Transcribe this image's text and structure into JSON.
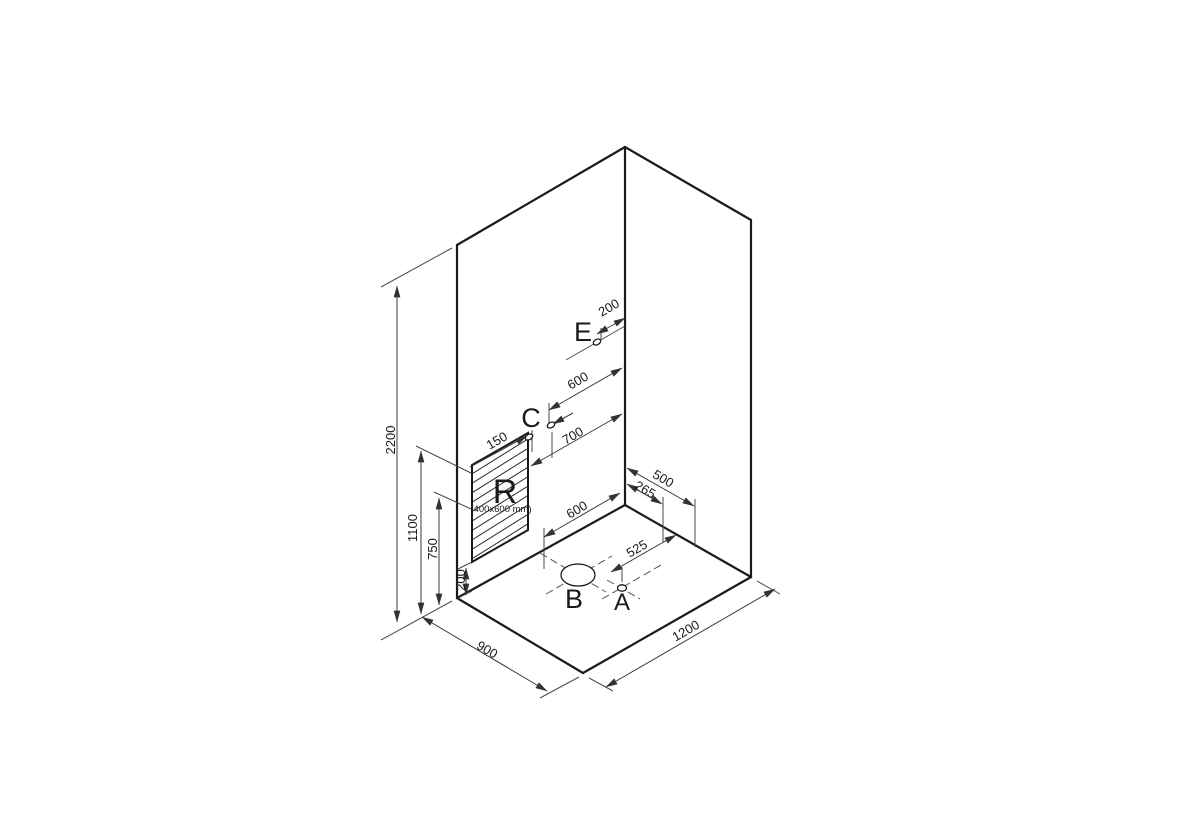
{
  "page": {
    "background": "#ffffff",
    "edge_color": "#1a1a1a",
    "thin_line_color": "#4a4a4a"
  },
  "labels": {
    "point_e": "E",
    "point_c": "C",
    "point_b": "B",
    "point_a": "A",
    "recess": "R",
    "recess_size": "(400x600 mm)"
  },
  "dimensions": {
    "total_height": "2200",
    "height_1100": "1100",
    "height_750": "750",
    "recess_bottom_200": "200",
    "recess_to_c_150": "150",
    "e_to_corner_200": "200",
    "c_to_corner_600": "600",
    "recess_to_corner_700": "700",
    "b_to_corner_600": "600",
    "right_wall_500": "500",
    "right_wall_265": "265",
    "floor_525": "525",
    "floor_width_1200": "1200",
    "floor_depth_900": "900"
  }
}
